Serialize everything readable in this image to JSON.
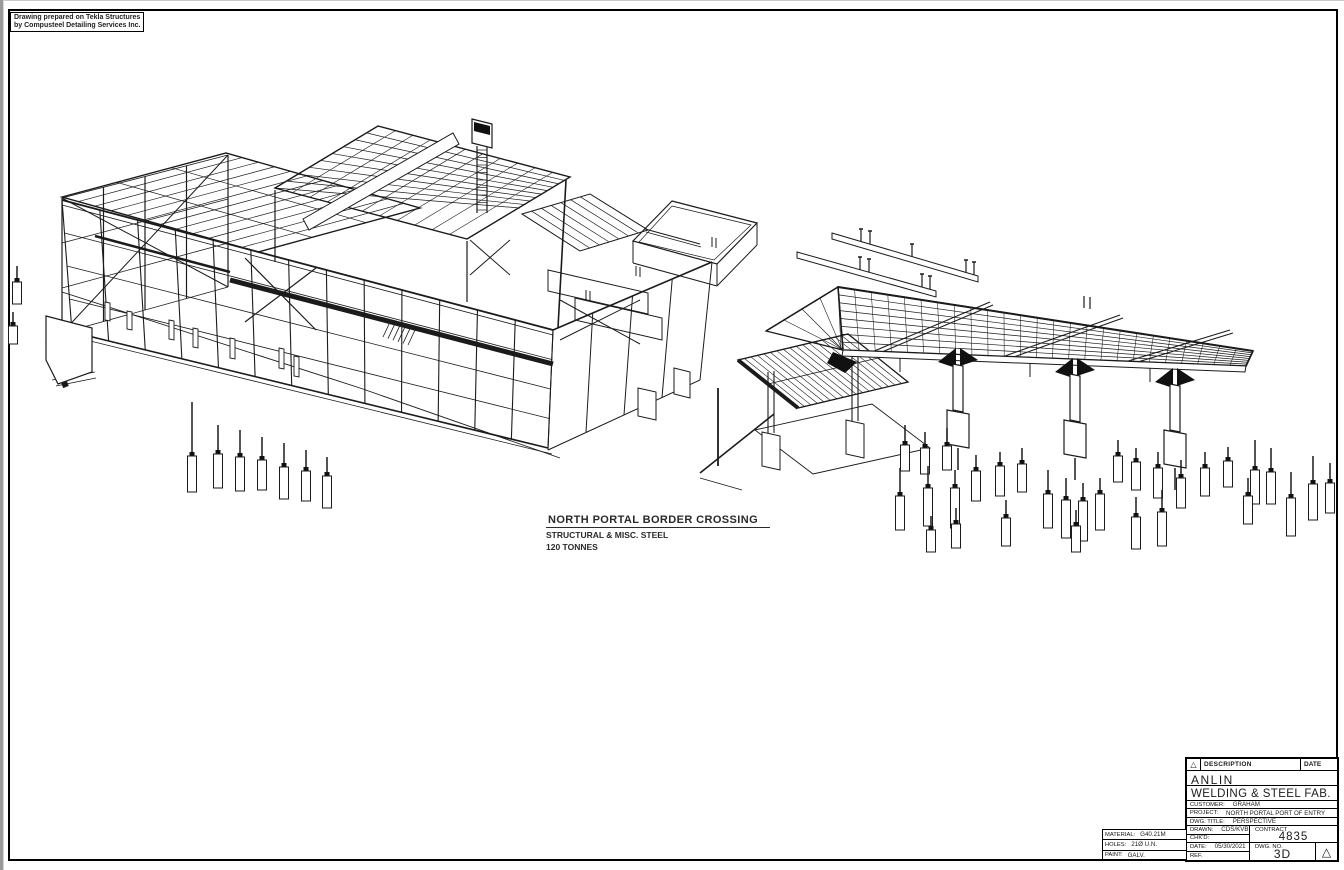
{
  "credit": {
    "line1": "Drawing prepared on Tekla Structures",
    "line2": "by Compusteel Detailing Services Inc."
  },
  "label": {
    "title": "NORTH PORTAL BORDER CROSSING",
    "line2": "STRUCTURAL & MISC. STEEL",
    "line3": "120 TONNES"
  },
  "title_block": {
    "header": {
      "description": "DESCRIPTION",
      "date": "DATE",
      "revision_triangle": "△"
    },
    "company": {
      "line1": "ANLIN",
      "line2": "WELDING & STEEL FAB."
    },
    "customer": {
      "label": "CUSTOMER:",
      "value": "GRAHAM"
    },
    "project": {
      "label": "PROJECT:",
      "value": "NORTH PORTAL PORT OF ENTRY"
    },
    "dwg_title": {
      "label": "DWG. TITLE:",
      "value": "PERSPECTIVE"
    },
    "drawn": {
      "label": "DRAWN:",
      "value": "CDS/KVB"
    },
    "chkd": {
      "label": "CHK'D:",
      "value": ""
    },
    "date": {
      "label": "DATE:",
      "value": "05/30/2021"
    },
    "ref": {
      "label": "REF.",
      "value": ""
    },
    "contract": {
      "label": "CONTRACT",
      "value": "4835"
    },
    "dwg_no": {
      "label": "DWG. NO.",
      "value": "3D"
    },
    "material": {
      "label": "MATERIAL:",
      "value": "G40.21M"
    },
    "holes": {
      "label": "HOLES:",
      "value": "21Ø U.N."
    },
    "paint": {
      "label": "PAINT:",
      "value": "GALV."
    },
    "corner_triangle": "△"
  },
  "colors": {
    "line": "#1b1b1b",
    "paper": "#ffffff",
    "edge_gray": "#9a9a9a"
  }
}
